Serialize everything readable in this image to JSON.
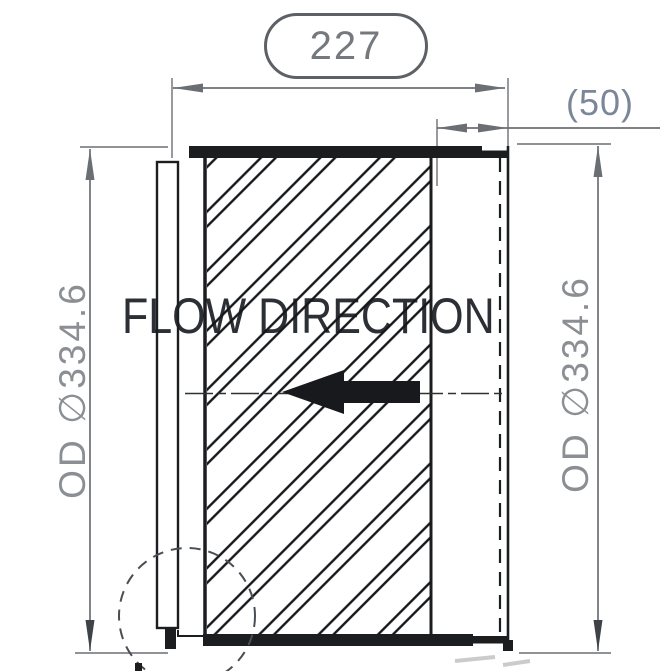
{
  "labels": {
    "flow_direction": "FLOW DIRECTION"
  },
  "dimensions": {
    "overall_length": {
      "value": "227",
      "style": "balloon"
    },
    "reference_length": {
      "display": "(50)",
      "value": "50"
    },
    "outer_diameter_left": {
      "display": "OD ∅334.6"
    },
    "outer_diameter_right": {
      "display": "OD ∅334.6"
    }
  },
  "colors": {
    "bg": "#ffffff",
    "part_line": "#1b1d1f",
    "dim_line": "#6b6f73",
    "dim_text": "#75797d",
    "ref_text": "#7b8698",
    "flow_text": "#2c3036",
    "arrow_fill": "#17191c",
    "balloon_border": "#5d6165",
    "centerline": "#2e3236",
    "detail_circle": "#4a4e52",
    "smudge": "#c9cbcd",
    "dim_arrow_dark": "#3f4347"
  }
}
